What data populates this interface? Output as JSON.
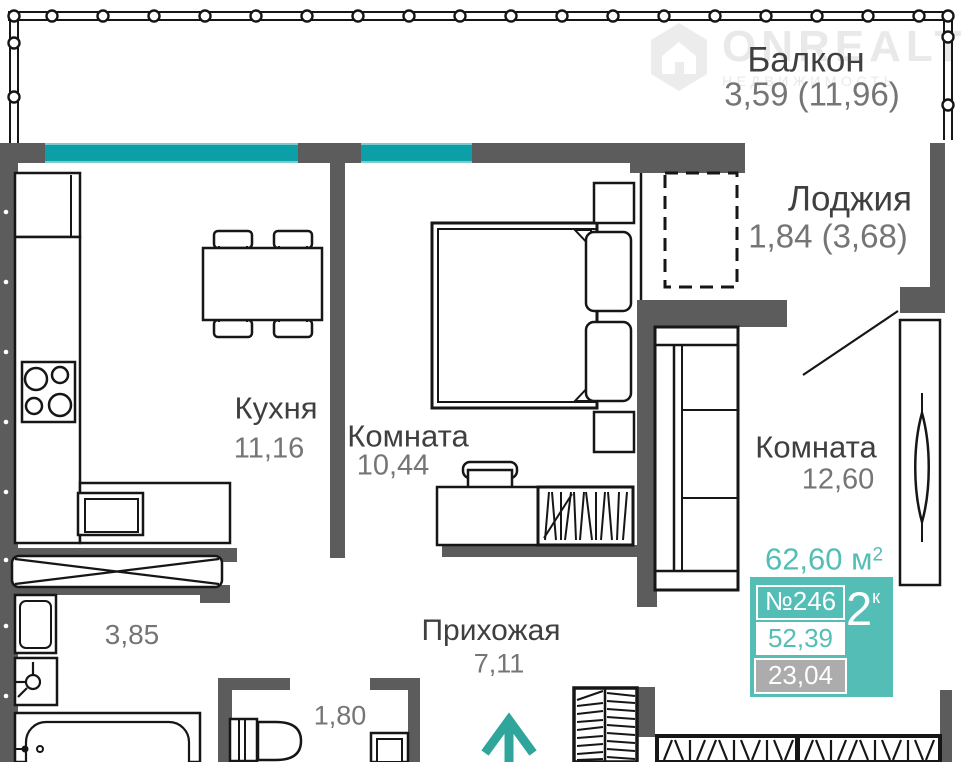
{
  "watermark": {
    "brand": "ONREALT",
    "subtitle": "НЕДВИЖИМОСТЬ"
  },
  "labels": {
    "balcony_name": "Балкон",
    "balcony_area": "3,59 (11,96)",
    "loggia_name": "Лоджия",
    "loggia_area": "1,84 (3,68)",
    "kitchen_name": "Кухня",
    "kitchen_area": "11,16",
    "bedroom_name": "Комната",
    "bedroom_area": "10,44",
    "living_name": "Комната",
    "living_area": "12,60",
    "hallway_name": "Прихожая",
    "hallway_area": "7,11",
    "bathroom_area": "3,85",
    "wc_area": "1,80"
  },
  "badge": {
    "total_value": "62,60",
    "total_unit": " м",
    "total_sup": "2",
    "apartment_number": "№246",
    "rooms_value": "2",
    "rooms_suffix": "к",
    "living_space": "52,39",
    "secondary_space": "23,04"
  },
  "colors": {
    "wall": "#5C5C5C",
    "window": "#0D9FA7",
    "accent": "#54BEB6",
    "muted": "#ACACAC",
    "arrow": "#2FA59C"
  }
}
